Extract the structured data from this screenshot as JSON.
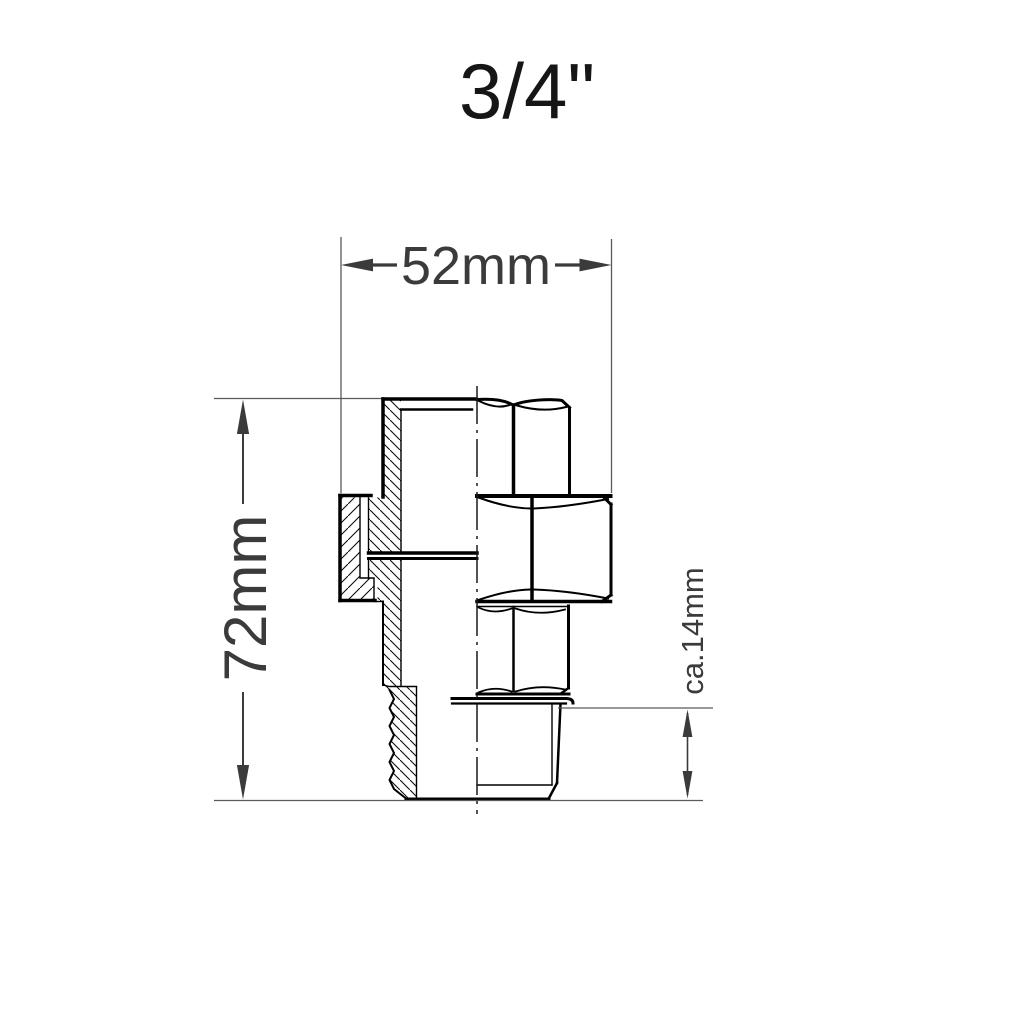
{
  "title": {
    "text": "3/4\""
  },
  "drawing": {
    "description": "Cross-section technical drawing of a 3/4 inch pipe union fitting",
    "dimensions": {
      "width": "52mm",
      "height": "72mm",
      "thread_length": "ca.14mm"
    },
    "colors": {
      "outline": "#000000",
      "dimension_text": "#3b3b3b",
      "dimension_lines": "#5a5a5a",
      "background": "#ffffff"
    }
  }
}
